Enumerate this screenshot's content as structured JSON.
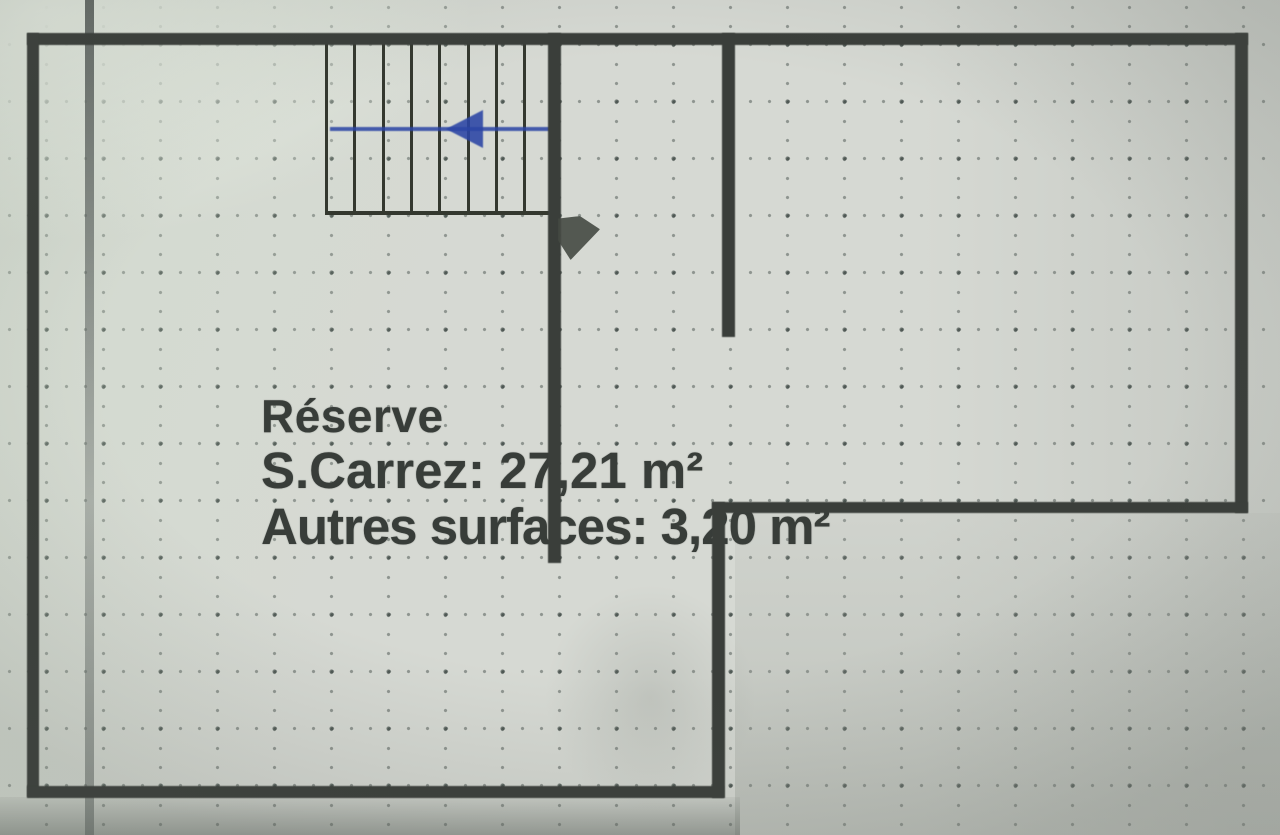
{
  "plan": {
    "room": {
      "label": "Réserve",
      "carrez_line": "S.Carrez: 27,21 m²",
      "autres_line": "Autres surfaces: 3,20 m²",
      "carrez_value_m2": "27,21",
      "autres_value_m2": "3,20"
    },
    "icons": {
      "stair_direction_arrow": "left-arrow",
      "door_swing_mark": "filled-triangle"
    },
    "colors": {
      "paper": "#d6d9d3",
      "wall": "#3a3e3a",
      "grid_dots": "#485249",
      "stair_arrow_blue": "#2b45a5",
      "label_text": "#383d39"
    }
  }
}
